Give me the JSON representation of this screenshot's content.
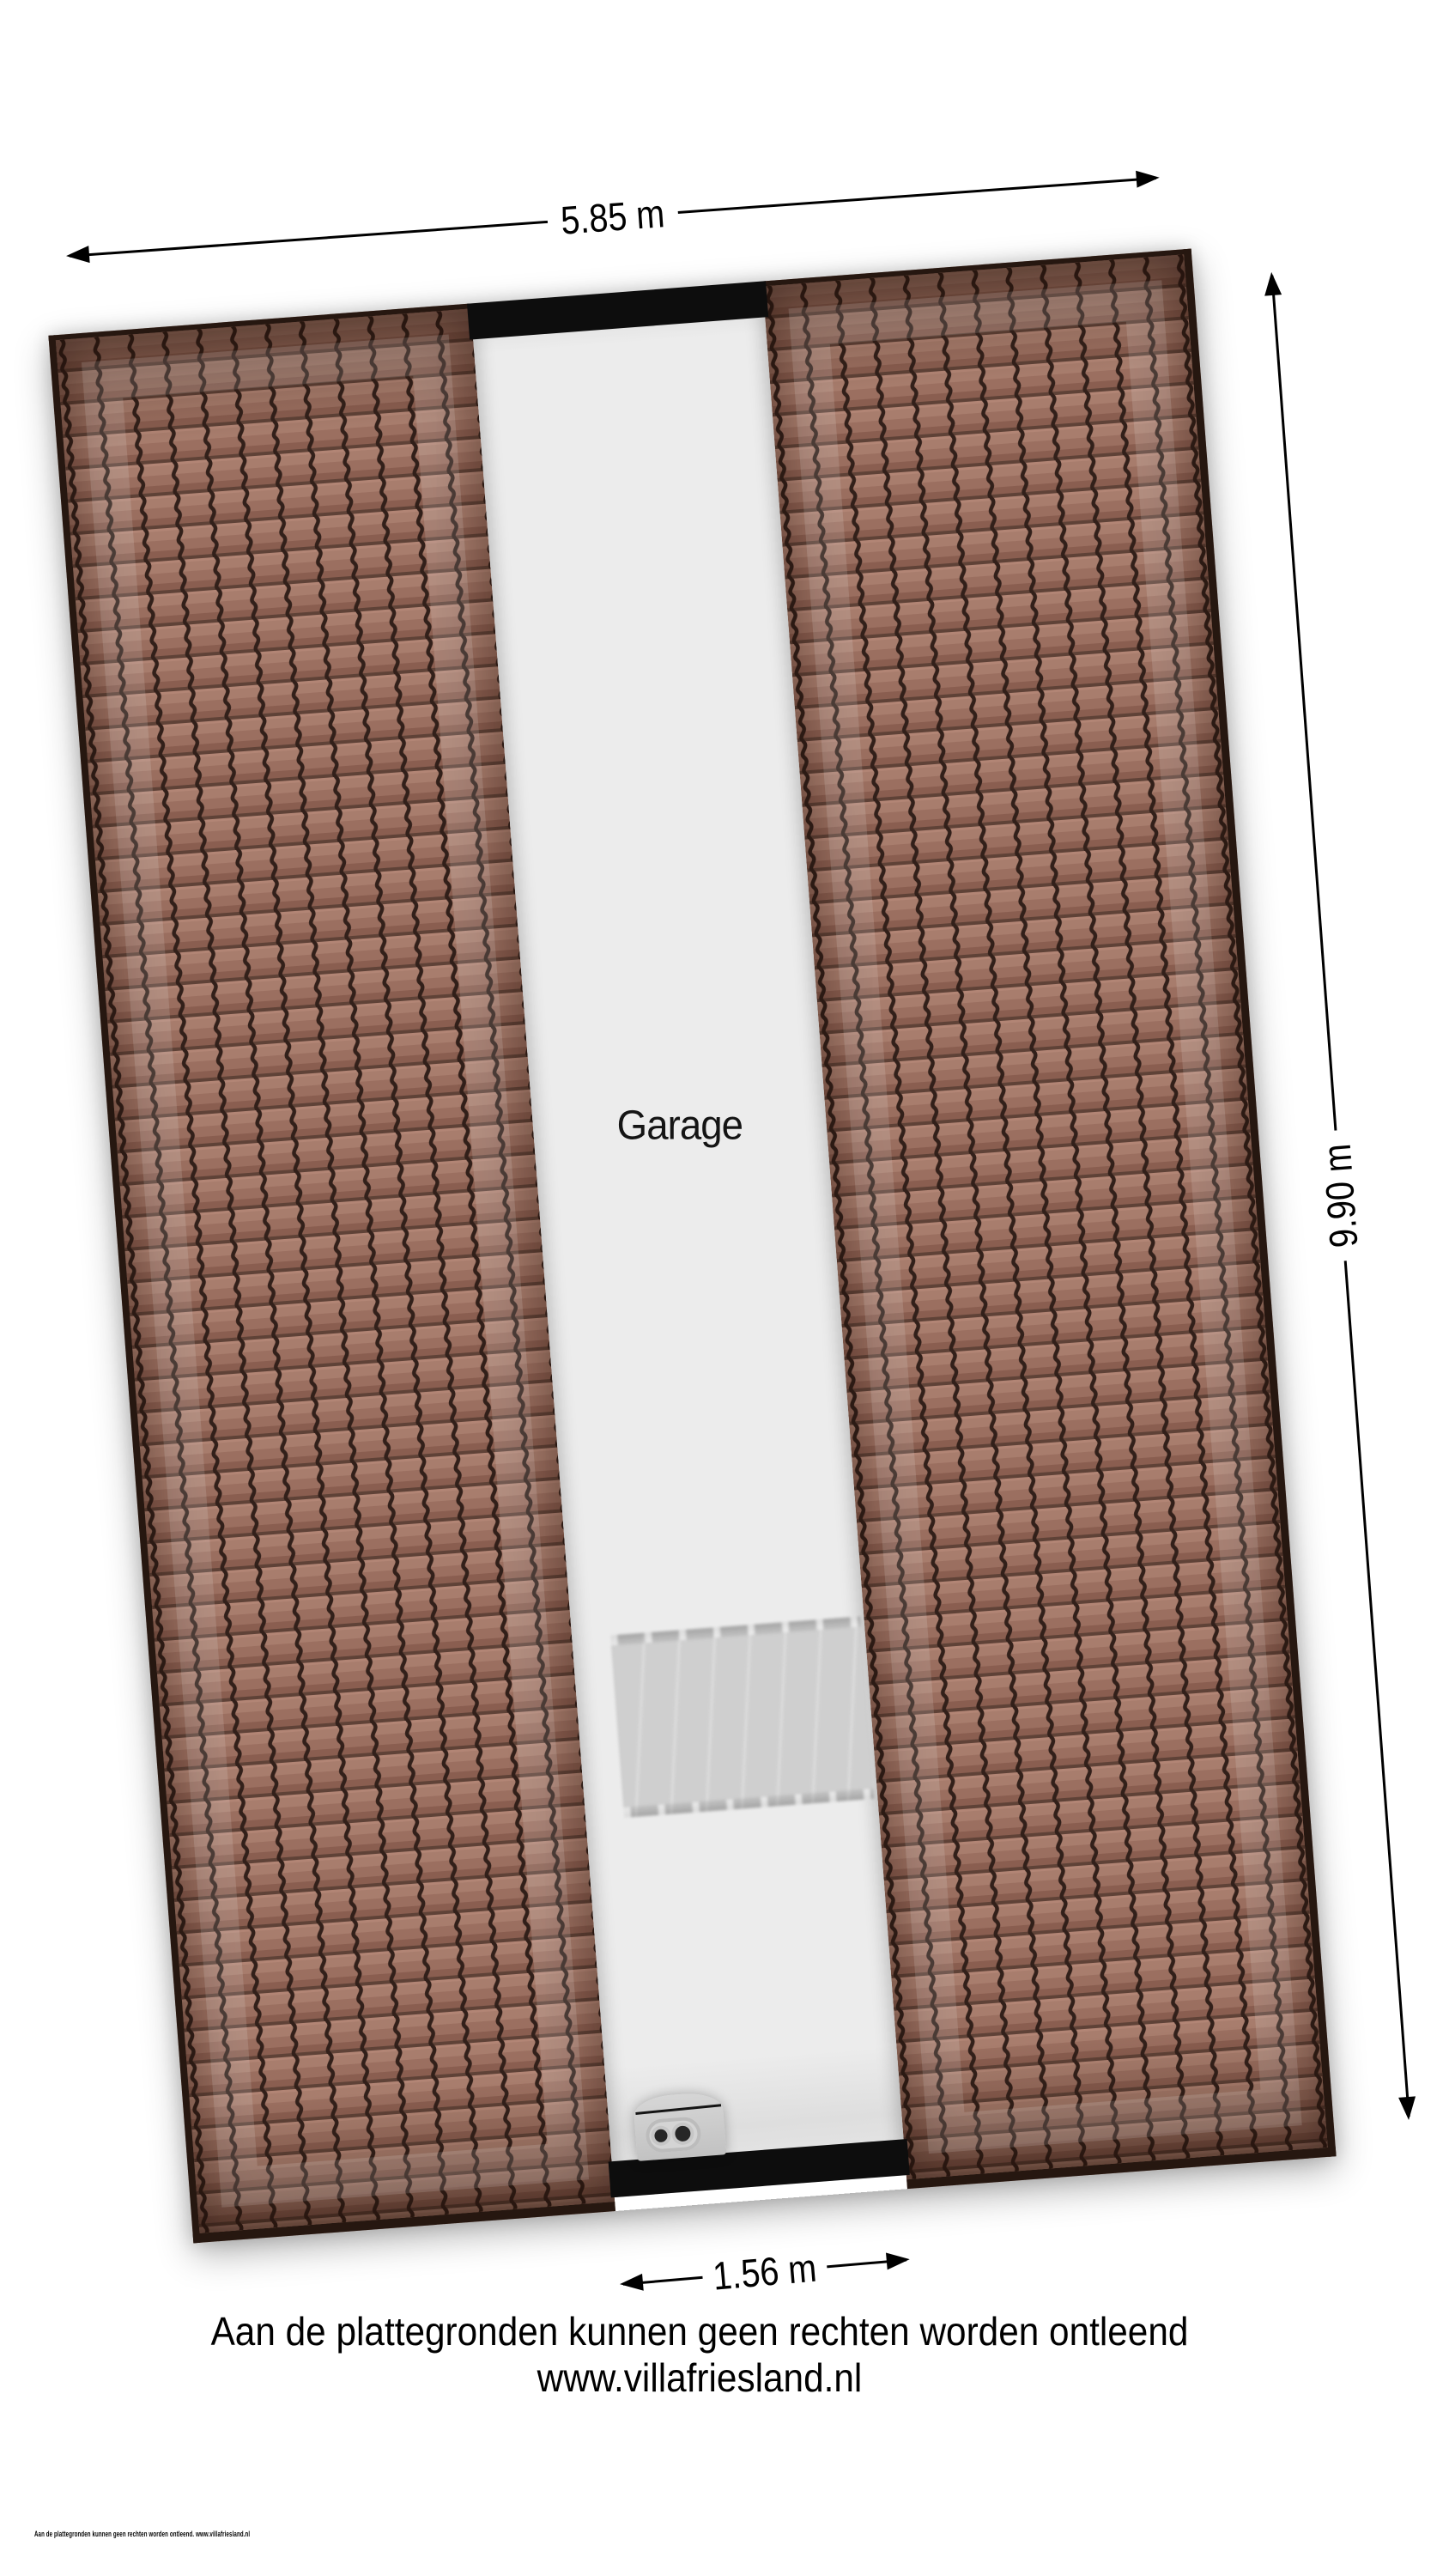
{
  "plan": {
    "room_label": "Garage",
    "dimensions": {
      "top": "5.85 m",
      "right": "9.90 m",
      "bottom": "1.56 m"
    },
    "elements": {
      "left_roof": "tiled roof slope",
      "right_roof": "tiled roof slope",
      "staircase": "staircase",
      "boiler": "boiler unit (top view)"
    },
    "colors": {
      "tile_base": "#9b6f60",
      "tile_light": "#a87d6d",
      "tile_dark": "#8a5e50",
      "tile_ridge_line": "#32201a",
      "roof_edge": "#261710",
      "garage_floor": "#ececec",
      "wall_band": "#0d0d0d",
      "stair_gray": "#cfcfcf",
      "text": "#000000"
    }
  },
  "footer": {
    "disclaimer": "Aan de plattegronden kunnen geen rechten worden ontleend",
    "website": "www.villafriesland.nl",
    "fine_print": "Aan de plattegronden kunnen geen rechten worden ontleend. www.villafriesland.nl"
  }
}
